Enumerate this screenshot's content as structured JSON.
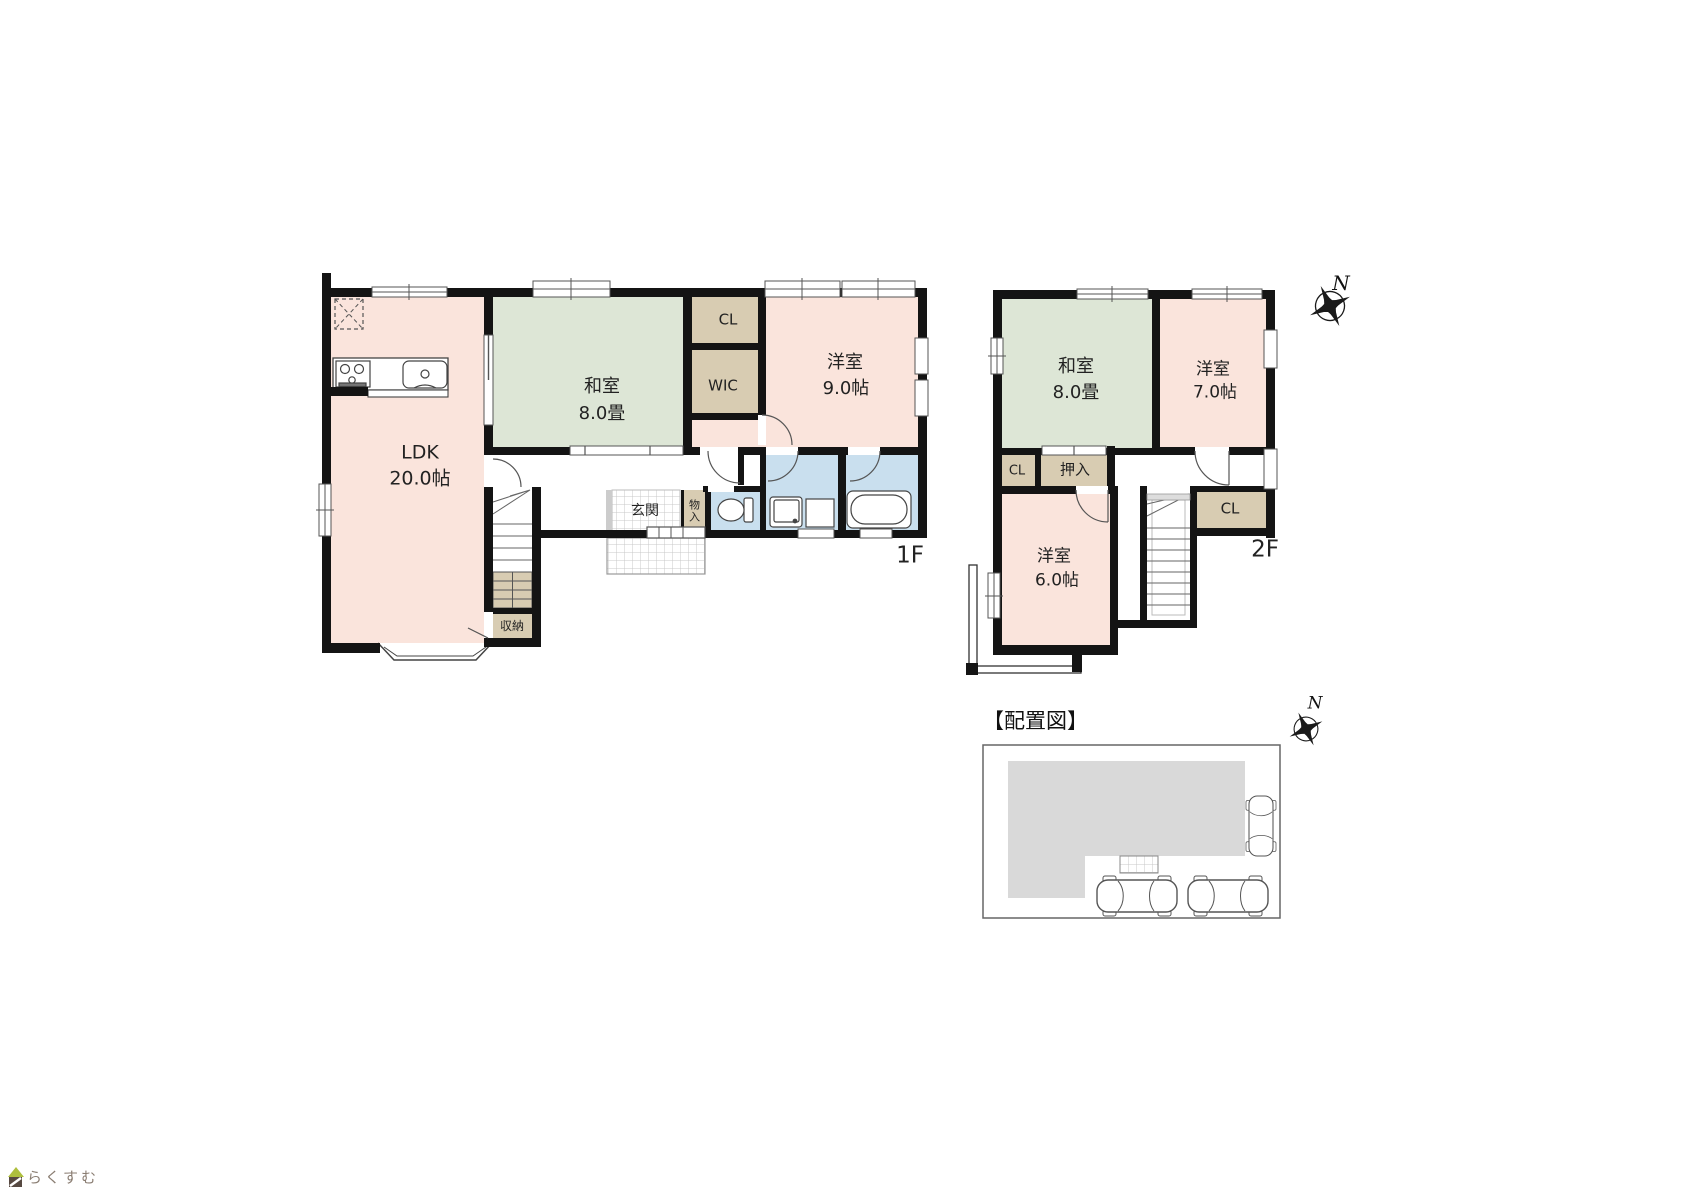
{
  "colors": {
    "wall": "#141414",
    "room_pink": "#fae4dc",
    "room_green": "#dde6d6",
    "closet_tan": "#d8ccb2",
    "wet_blue": "#c9dfee",
    "site_building_gray": "#d9d9d9",
    "logo_roof_green": "#aebf3e",
    "logo_body_brown": "#574941",
    "logo_text_brown": "#8a7d72"
  },
  "floor1": {
    "floor_label": "1F",
    "ldk": {
      "name": "LDK",
      "size": "20.0帖"
    },
    "washitsu": {
      "name": "和室",
      "size": "8.0畳"
    },
    "youshitsu": {
      "name": "洋室",
      "size": "9.0帖"
    },
    "closet": "CL",
    "wic": "WIC",
    "entrance": "玄関",
    "small_storage": "物入",
    "storage": "収納"
  },
  "floor2": {
    "floor_label": "2F",
    "washitsu": {
      "name": "和室",
      "size": "8.0畳"
    },
    "youshitsu7": {
      "name": "洋室",
      "size": "7.0帖"
    },
    "youshitsu6": {
      "name": "洋室",
      "size": "6.0帖"
    },
    "closet_left": "CL",
    "oshiire": "押入",
    "closet_right": "CL"
  },
  "site_plan": {
    "title": "【配置図】"
  },
  "compass": {
    "north": "N"
  },
  "logo": {
    "text": "らくすむ"
  }
}
